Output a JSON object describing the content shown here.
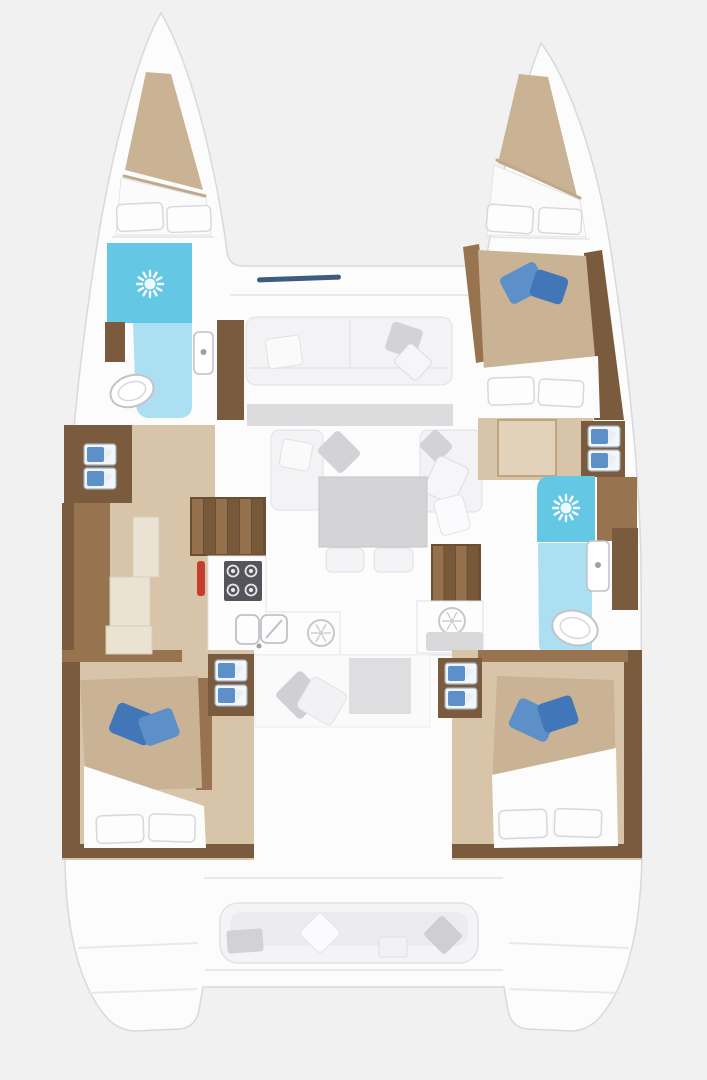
{
  "scene": {
    "name": "catamaran-interior-floorplan",
    "areas": [
      "port-bow-locker",
      "port-forward-head",
      "port-corridor",
      "galley",
      "companionway-stairs-port",
      "salon",
      "nav-station",
      "companionway-stairs-starboard",
      "starboard-bow-cabin",
      "starboard-corridor",
      "starboard-aft-head",
      "port-aft-cabin",
      "starboard-aft-cabin",
      "cockpit"
    ]
  },
  "icons": {
    "shower": "sun-rays-icon",
    "stove": "four-burner-icon",
    "vent": "round-dial-icon"
  },
  "colors": {
    "background": "#f1f1f2",
    "hull_white": "#fcfcfd",
    "outline_gray": "#d9d9dc",
    "wood_dark": "#7a5b3e",
    "wood_mid": "#97744f",
    "floor_tan": "#d8c5a9",
    "bedding_tan": "#c9b394",
    "cream": "#eae3d3",
    "shower_blue": "#64c8e4",
    "bath_floor_blue": "#abdff1",
    "pillow_blue": "#5d8fc9",
    "pillow_blue_dark": "#4176b8",
    "sofa_white": "#f3f3f5",
    "cushion_gray": "#d3d3d7",
    "table_gray": "#d4d4d7",
    "stove_dark": "#54545a",
    "accent_red": "#c63d2f",
    "canvas_navy": "#3d5c80"
  }
}
